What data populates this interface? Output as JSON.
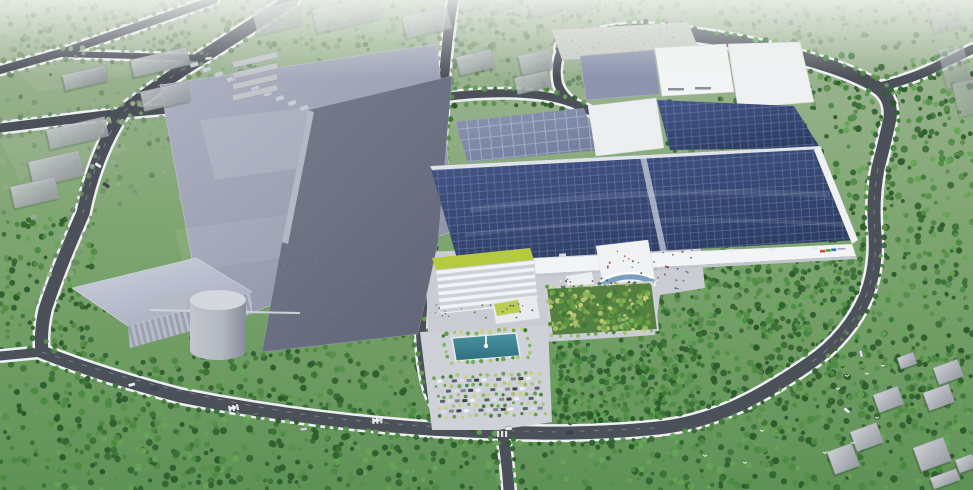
{
  "scene": {
    "description": "Aerial bird's-eye 3D architectural rendering of an industrial campus: large factory halls, a main production building with rooftop solar arrays, a lime-green office block, landscaped plaza with fountain and parking lot, surrounded by dense forest, roads and scattered houses under a hazy horizon",
    "time_of_day": "daytime, hazy",
    "view": "oblique aerial"
  },
  "palette": {
    "land_top": "#a7b89e",
    "land_mid": "#7fa671",
    "land_bottom": "#5f9256",
    "forest_dark": "#2f6030",
    "forest_main": "#4c8a42",
    "forest_light": "#66a457",
    "road_asphalt": "#4b5059",
    "road_edge": "#eef0f3",
    "hall_roof_light": "#b0b4c4",
    "hall_roof_dark": "#787d8d",
    "solar_panel": "#2c3b61",
    "solar_panel_light": "#8d97b4",
    "white_building": "#f3f4f5",
    "green_roof": "#b6ca3f",
    "glass_blue": "#5d87b8",
    "pool_teal": "#2f6f80",
    "silo_gray": "#c2c6cc",
    "gravel": "#c9cbc5",
    "plaza": "#ccd0d5",
    "haze": "#f0f3ef"
  },
  "logo": {
    "label": "company logo on facade (illegible at this scale)",
    "colors": [
      "#d2463e",
      "#4fa53c",
      "#2f6fc0",
      "#9aa2ad"
    ]
  }
}
